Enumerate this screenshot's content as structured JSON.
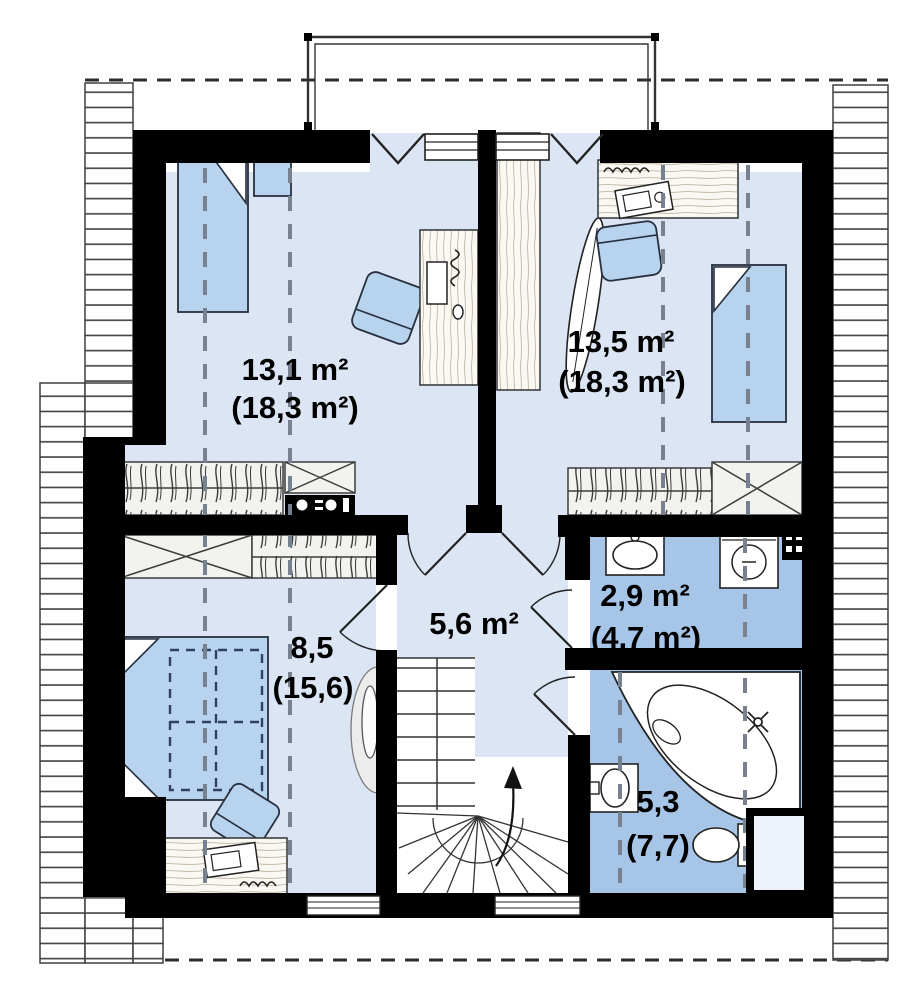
{
  "title": "Attic floor plan",
  "colors": {
    "wall": "#000000",
    "room_floor": "#dbe5f4",
    "bath_floor": "#a7c5e6",
    "furniture_blue": "#b7d3ee",
    "hatch_line": "#3f3f3f",
    "roof_dash": "#77818f"
  },
  "rooms": [
    {
      "name": "room-top-left",
      "area": "13,1 m²",
      "area_gross": "(18,3 m²)"
    },
    {
      "name": "room-top-right",
      "area": "13,5 m²",
      "area_gross": "(18,3 m²)"
    },
    {
      "name": "bedroom-bottom-left",
      "area": "8,5",
      "area_gross": "(15,6)"
    },
    {
      "name": "hall",
      "area": "5,6 m²",
      "area_gross": ""
    },
    {
      "name": "laundry",
      "area": "2,9 m²",
      "area_gross": "(4,7 m²)"
    },
    {
      "name": "bathroom",
      "area": "5,3",
      "area_gross": "(7,7)"
    }
  ]
}
